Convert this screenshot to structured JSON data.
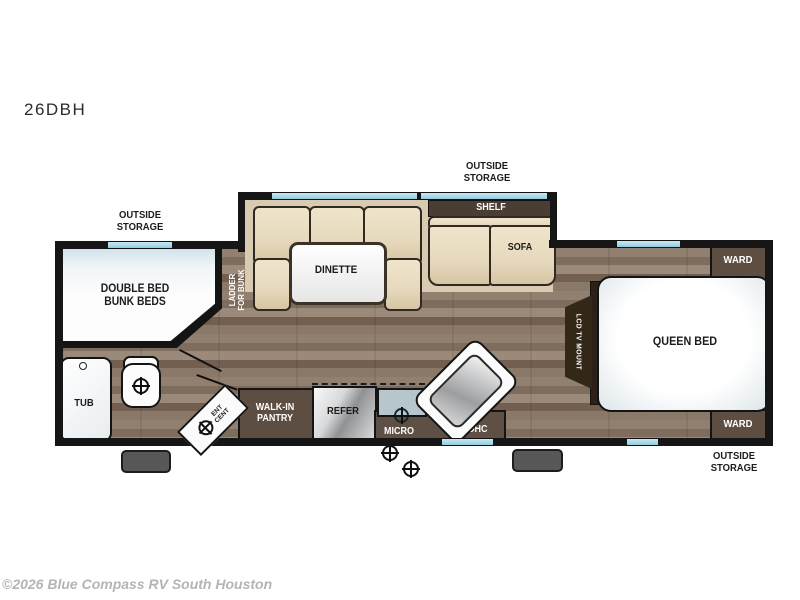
{
  "labels": {
    "model": "26DBH",
    "storage_tl": "OUTSIDE\nSTORAGE",
    "storage_tc": "OUTSIDE\nSTORAGE",
    "storage_br": "OUTSIDE\nSTORAGE",
    "shelf": "SHELF",
    "sofa": "SOFA",
    "dinette": "DINETTE",
    "ladder": "LADDER\nFOR BUNK",
    "bunk": "DOUBLE BED\nBUNK BEDS",
    "tub": "TUB",
    "pantry": "WALK-IN\nPANTRY",
    "refer": "REFER",
    "micro": "MICRO",
    "ohc": "OHC",
    "ent_cent": "ENT\nCENT",
    "lcd": "LCD TV MOUNT",
    "queen": "QUEEN BED",
    "ward_top": "WARD",
    "ward_bottom": "WARD"
  },
  "footer": {
    "copyright": "©2026 Blue Compass RV South Houston"
  },
  "colors": {
    "wall": "#161616",
    "window_blue": "#a9d8e9",
    "floor_base": "#8a796a",
    "cushion_tan": "#e7dabe",
    "slide_beige": "#d9cbb1",
    "cabinet_brown": "#5e4e41",
    "counter_brown": "#5e5044",
    "shelf_brown": "#4a3d33",
    "refer_silver": "#c7c9ca",
    "stove_blue": "#b6c6cc",
    "step_gray": "#575757",
    "footer_gray": "#b4b4b4"
  }
}
